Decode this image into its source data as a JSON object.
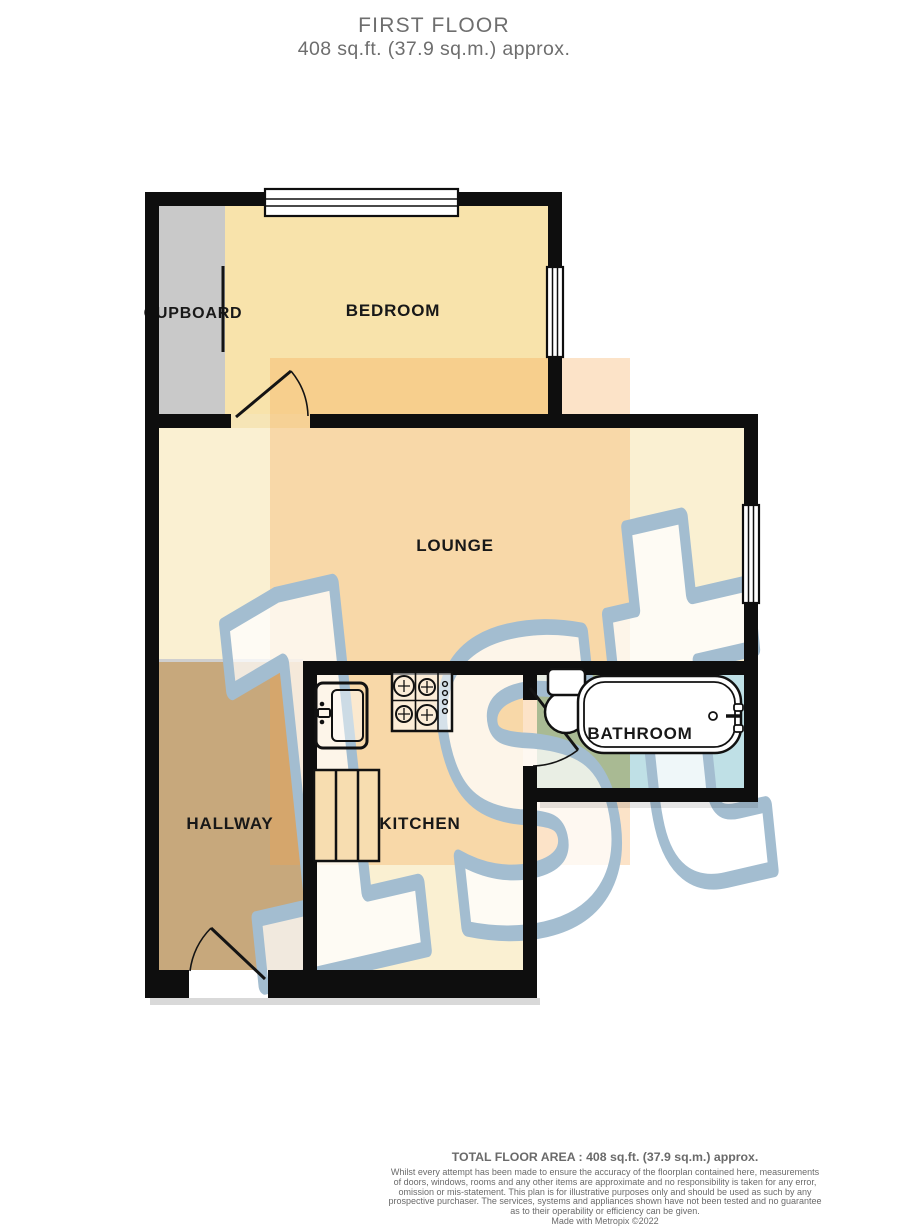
{
  "title": {
    "line1": "FIRST FLOOR",
    "line2": "408 sq.ft. (37.9 sq.m.) approx."
  },
  "plan": {
    "wall_color": "#0e0e0e",
    "window_fill": "#ffffff",
    "rooms": [
      {
        "id": "cupboard",
        "label": "CUPBOARD",
        "floor_color": "#c9c9c9"
      },
      {
        "id": "bedroom",
        "label": "BEDROOM",
        "floor_color": "#f8e3ab"
      },
      {
        "id": "lounge",
        "label": "LOUNGE",
        "floor_color": "#faf0d2"
      },
      {
        "id": "hallway",
        "label": "HALLWAY",
        "floor_color": "#c7a87c"
      },
      {
        "id": "kitchen",
        "label": "KITCHEN",
        "floor_color": "#faf0d2"
      },
      {
        "id": "bathroom",
        "label": "BATHROOM",
        "floor_color_left": "#a9ba93",
        "floor_color_right": "#bfe0e6"
      }
    ],
    "fixtures": [
      "sink",
      "stove",
      "kitchen-cabinet",
      "toilet",
      "bathtub"
    ]
  },
  "watermark": {
    "text": "1st",
    "outline_color": "#a3bdd0",
    "fill_color": "rgba(255,255,255,0.75)",
    "band_color": "rgba(245,162,74,0.30)"
  },
  "footer": {
    "total_area": "TOTAL FLOOR AREA : 408 sq.ft. (37.9 sq.m.) approx.",
    "disclaimer_lines": [
      "Whilst every attempt has been made to ensure the accuracy of the floorplan contained here, measurements",
      "of doors, windows, rooms and any other items are approximate and no responsibility is taken for any error,",
      "omission or mis-statement. This plan is for illustrative purposes only and should be used as such by any",
      "prospective purchaser. The services, systems and appliances shown have not been tested and no guarantee",
      "as to their operability or efficiency can be given."
    ],
    "credit": "Made with Metropix ©2022"
  }
}
